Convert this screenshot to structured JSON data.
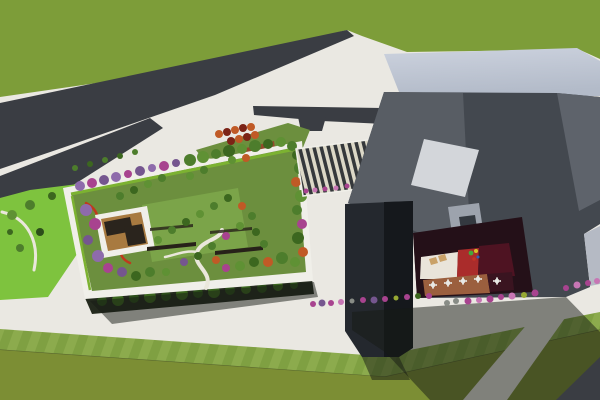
{
  "scene": {
    "title": "Aerial 3D architectural rendering: rooftop garden building, angular gray building with courtyard, roads and lawns",
    "elements": [
      "grass-field-north",
      "main-road",
      "branch-road",
      "service-road",
      "sidewalks",
      "ground-level-park",
      "rooftop-garden-building",
      "rooftop-lawn",
      "winding-garden-path",
      "garden-pavilion-deck",
      "bench-rows",
      "flowering-trees",
      "red-flower-border",
      "street-tree-rows",
      "bus-shelter",
      "timber-plaza-deck",
      "striped-entry-canopy",
      "main-building-roof",
      "main-building-facades",
      "roof-skylight",
      "entry-door",
      "building-leg",
      "recessed-courtyard",
      "courtyard-white-floor",
      "courtyard-red-floor",
      "courtyard-maroon-floor",
      "cafe-deck",
      "cafe-tables",
      "sun-loungers",
      "playground-unit",
      "flower-bush-row",
      "building-shadows",
      "south-lawn",
      "mowing-stripe-band",
      "corner-road"
    ],
    "colors": {
      "pavement": "#eae8e2",
      "grass_top": "#7d9d39",
      "road": "#3a3d43",
      "field_lawn": "#7c8e34",
      "lawn_stripe_a": "#8cab4d",
      "lawn_stripe_b": "#7fa042",
      "park_lawn": "#7ec33e",
      "garden_lawn": "#6c8f3e",
      "garden_lawn_light": "#7ba449",
      "garden_parapet": "#f0efe9",
      "garden_facade": "#242a1e",
      "hedge": "#7cb231",
      "path_white": "#eae7db",
      "flower_red": "#bf3a1d",
      "deck_wood": "#a87a40",
      "pergola_dark": "#2a241d",
      "bench_dark": "#272119",
      "canopy_stripe_light": "#dcd8c7",
      "canopy_stripe_dark": "#35383b",
      "roof_light_1": "#ccd2de",
      "roof_light_2": "#b3bbc9",
      "face_left": "#585d64",
      "face_main": "#43484f",
      "face_right": "#5e636b",
      "face_light": "#b5bac4",
      "leg_dark": "#24282e",
      "leg_shade": "#15181c",
      "skylight": "#d3d6da",
      "door_panel": "#9da3ad",
      "door_inset": "#343940",
      "courtyard_base": "#241018",
      "courtyard_white": "#e9e4da",
      "courtyard_red": "#aa2c2b",
      "courtyard_maroon": "#4e1322",
      "courtyard_deck": "#9b5f3e",
      "courtyard_deck_dark": "#3a1420",
      "lounger": "#c9a168",
      "table_white": "#e8e8e4",
      "play_green": "#44a83c",
      "play_yellow": "#d8c32a",
      "play_red": "#c23427",
      "play_blue": "#2e5fb8",
      "shelter_dark": "#22262b",
      "deck_red_brown": "#93492b",
      "tree_green_1": "#4d7d2c",
      "tree_green_2": "#5f9134",
      "tree_green_3": "#3c671f",
      "tree_green_dark": "#2c4e1a",
      "tree_purple_1": "#8e6bab",
      "tree_purple_2": "#75568f",
      "tree_magenta": "#a8438f",
      "tree_pink": "#c776b4",
      "tree_orange": "#c05a26",
      "tree_dark_red": "#7c2316",
      "tree_yellow_green": "#97a833",
      "bush_gray": "#888c86",
      "people_dark": "#27272a",
      "line_lawn": "#5a682e",
      "shadow": "rgba(22,26,20,0.5)"
    }
  }
}
